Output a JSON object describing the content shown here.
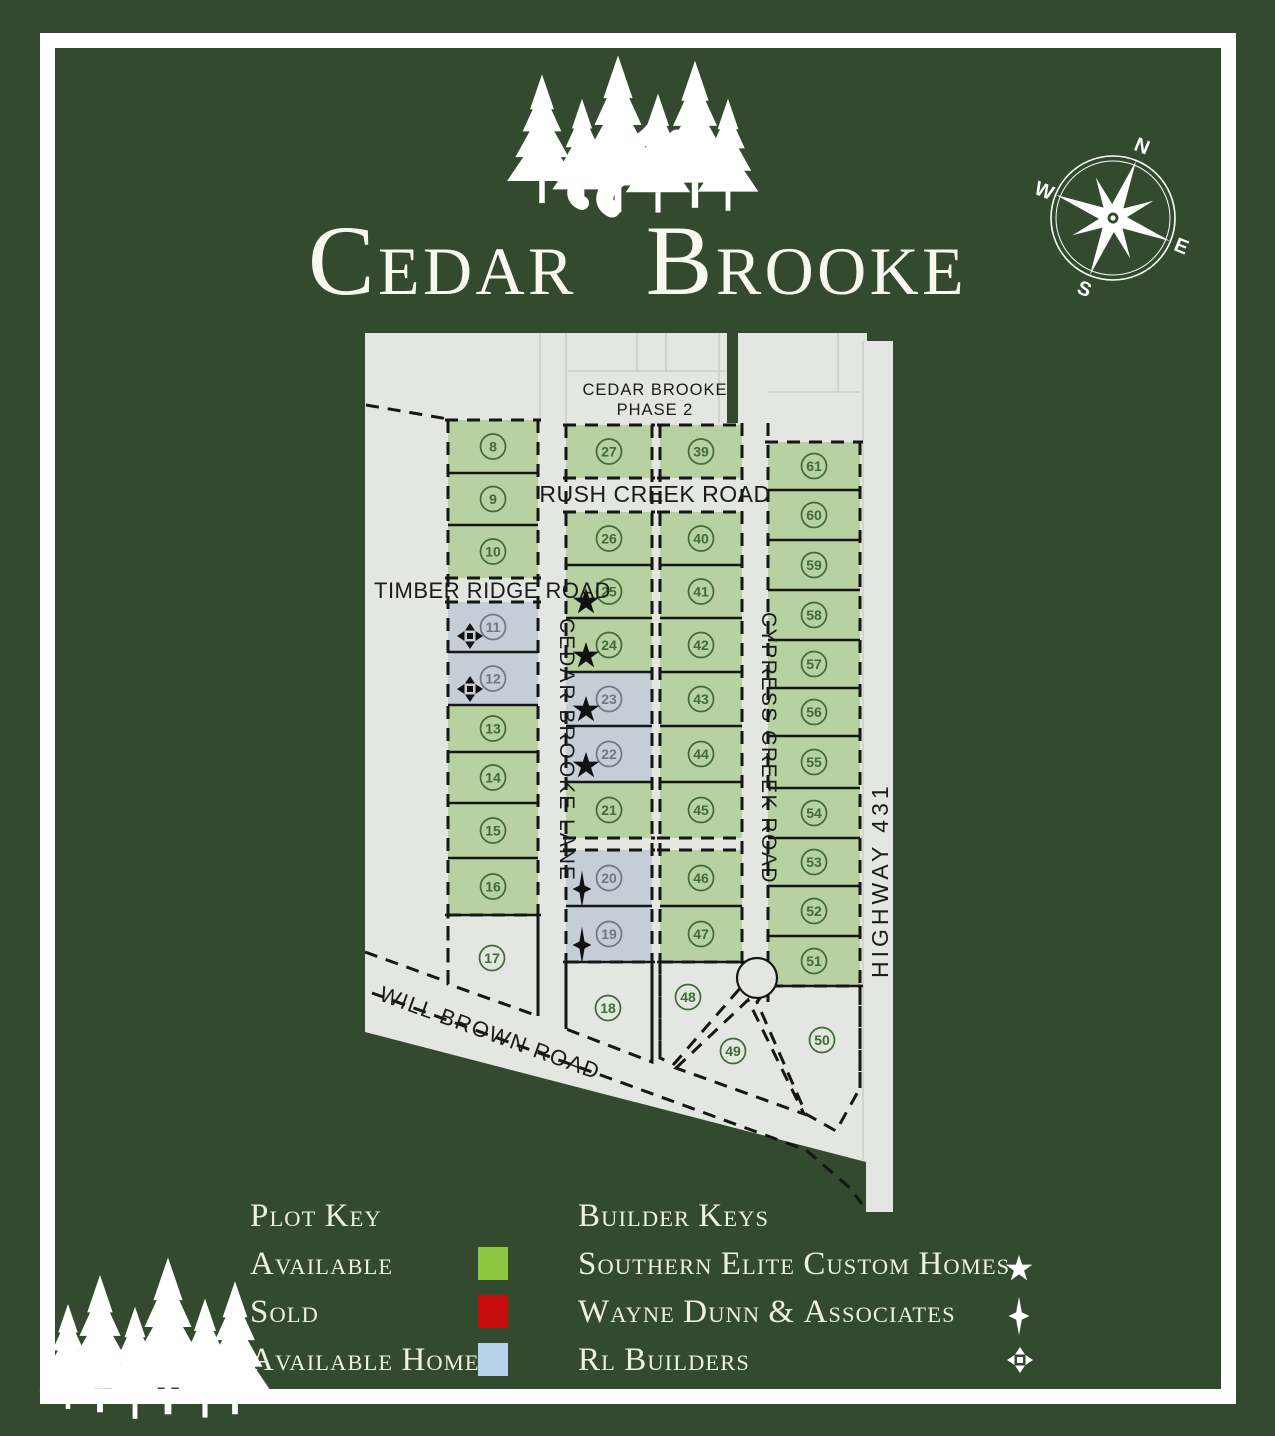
{
  "title": "Cedar Brooke",
  "compass": {
    "n": "N",
    "e": "E",
    "s": "S",
    "w": "W"
  },
  "map": {
    "phase2_line1": "CEDAR BROOKE",
    "phase2_line2": "PHASE 2",
    "roads": {
      "rush_creek": "RUSH CREEK ROAD",
      "timber_ridge": "TIMBER RIDGE ROAD",
      "cedar_brooke_lane": "CEDAR BROOKE LANE",
      "cypress_creek": "CYPRESS CREEK ROAD",
      "highway": "HIGHWAY 431",
      "will_brown": "WILL BROWN ROAD"
    },
    "columns": [
      {
        "x": 448,
        "w": 90,
        "vlines": [
          {
            "x": 448,
            "y1": 420,
            "y2": 984
          },
          {
            "x": 538,
            "y1": 420,
            "y2": 1016
          }
        ],
        "groups": [
          {
            "top": 420,
            "bottom": "dash",
            "lots": [
              {
                "n": 8,
                "h": 53
              },
              {
                "n": 9,
                "h": 52
              },
              {
                "n": 10,
                "h": 53
              }
            ]
          },
          {
            "top": 602,
            "bottom": "solid",
            "lots": [
              {
                "n": 11,
                "h": 50,
                "s": "h",
                "b": "rl"
              },
              {
                "n": 12,
                "h": 53,
                "s": "h",
                "b": "rl"
              },
              {
                "n": 13,
                "h": 47
              },
              {
                "n": 14,
                "h": 51
              },
              {
                "n": 15,
                "h": 55
              },
              {
                "n": 16,
                "h": 57
              }
            ]
          }
        ]
      },
      {
        "x": 566,
        "w": 86,
        "vlines": [
          {
            "x": 566,
            "y1": 425,
            "y2": 1029
          },
          {
            "x": 652,
            "y1": 425,
            "y2": 1062
          }
        ],
        "groups": [
          {
            "top": 425,
            "bottom": "dash",
            "lots": [
              {
                "n": 27,
                "h": 53
              }
            ]
          },
          {
            "top": 512,
            "bottom": "dash",
            "lots": [
              {
                "n": 26,
                "h": 53
              },
              {
                "n": 25,
                "h": 53,
                "b": "se"
              },
              {
                "n": 24,
                "h": 54,
                "b": "se"
              },
              {
                "n": 23,
                "h": 54,
                "s": "h",
                "b": "se"
              },
              {
                "n": 22,
                "h": 56,
                "s": "h",
                "b": "se"
              },
              {
                "n": 21,
                "h": 56
              }
            ]
          },
          {
            "top": 850,
            "bottom": "solid",
            "lots": [
              {
                "n": 20,
                "h": 56,
                "s": "h",
                "b": "wd"
              },
              {
                "n": 19,
                "h": 56,
                "s": "h",
                "b": "wd"
              }
            ]
          }
        ]
      },
      {
        "x": 660,
        "w": 82,
        "vlines": [
          {
            "x": 660,
            "y1": 425,
            "y2": 1060
          },
          {
            "x": 742,
            "y1": 423,
            "y2": 986
          }
        ],
        "groups": [
          {
            "top": 425,
            "bottom": "dash",
            "lots": [
              {
                "n": 39,
                "h": 53
              }
            ]
          },
          {
            "top": 512,
            "bottom": "dash",
            "lots": [
              {
                "n": 40,
                "h": 53
              },
              {
                "n": 41,
                "h": 53
              },
              {
                "n": 42,
                "h": 54
              },
              {
                "n": 43,
                "h": 54
              },
              {
                "n": 44,
                "h": 56
              },
              {
                "n": 45,
                "h": 56
              }
            ]
          },
          {
            "top": 850,
            "bottom": "solid",
            "lots": [
              {
                "n": 46,
                "h": 56
              },
              {
                "n": 47,
                "h": 56
              }
            ]
          }
        ]
      },
      {
        "x": 768,
        "w": 92,
        "vlines": [
          {
            "x": 768,
            "y1": 423,
            "y2": 1002
          },
          {
            "x": 860,
            "y1": 442,
            "y2": 1088
          }
        ],
        "groups": [
          {
            "top": 442,
            "bottom": "solid",
            "lots": [
              {
                "n": 61,
                "h": 48
              },
              {
                "n": 60,
                "h": 50
              },
              {
                "n": 59,
                "h": 50
              },
              {
                "n": 58,
                "h": 50
              },
              {
                "n": 57,
                "h": 48
              },
              {
                "n": 56,
                "h": 48
              },
              {
                "n": 55,
                "h": 52
              },
              {
                "n": 54,
                "h": 50
              },
              {
                "n": 53,
                "h": 48
              },
              {
                "n": 52,
                "h": 50
              },
              {
                "n": 51,
                "h": 50
              }
            ]
          }
        ]
      }
    ],
    "poly_lots": [
      {
        "n": 17,
        "points": "448,915 538,915 538,1016 448,984",
        "cx": 492,
        "cy": 958
      },
      {
        "n": 18,
        "points": "566,962 652,962 652,1062 566,1029",
        "cx": 608,
        "cy": 1008
      },
      {
        "n": 48,
        "points": "660,962 742,962 742,986 674,1064 660,1058",
        "cx": 688,
        "cy": 997
      },
      {
        "n": 49,
        "points": "676,1068 748,1000 804,1114",
        "cx": 733,
        "cy": 1051
      },
      {
        "n": 50,
        "points": "770,986 860,986 860,1088 836,1131 806,1114 757,1002",
        "cx": 822,
        "cy": 1040
      }
    ],
    "dash_lines": [
      "366,405 448,419",
      "365,952 448,982",
      "372,993 620,1082 806,1150 850,1188 862,1204"
    ]
  },
  "legend": {
    "plot_key_title": "Plot Key",
    "plot_items": [
      {
        "label": "Available",
        "color": "#8dc63f"
      },
      {
        "label": "Sold",
        "color": "#c50d0d"
      },
      {
        "label": "Available Homes",
        "color": "#b9d2ea"
      }
    ],
    "builder_title": "Builder Keys",
    "builder_items": [
      {
        "label": "Southern Elite Custom Homes",
        "symbol": "star5"
      },
      {
        "label": "Wayne Dunn & Associates",
        "symbol": "star4"
      },
      {
        "label": "RL Builders",
        "symbol": "cross"
      }
    ]
  },
  "colors": {
    "background": "#334a2e",
    "frame": "#ffffff",
    "map_gray": "#e3e6e1",
    "lot_green": "#b7d1a1",
    "lot_blue": "#c5ced6",
    "circle_green": "#3f6b35",
    "circle_blue": "#6d7884",
    "line_dark": "#161616"
  }
}
